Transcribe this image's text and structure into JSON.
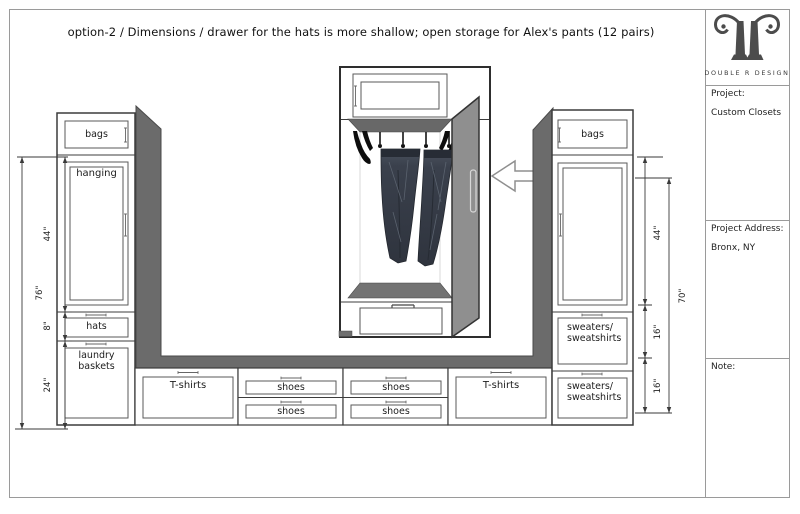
{
  "title": "option-2 / Dimensions / drawer for the hats is more shallow; open storage for Alex's pants (12 pairs)",
  "title_block": {
    "brand": "DOUBLE R DESIGN",
    "project_label": "Project:",
    "project_value": "Custom Closets",
    "address_label": "Project Address:",
    "address_value": "Bronx, NY",
    "note_label": "Note:"
  },
  "left_tower": {
    "cabinet": "bags",
    "door": "hanging",
    "drawer_small": "hats",
    "drawer_large": "laundry baskets",
    "dims": {
      "total": "76\"",
      "hanging": "44\"",
      "hats": "8\"",
      "laundry": "24\""
    }
  },
  "right_tower": {
    "cabinet": "bags",
    "drawer_1": "sweaters/ sweatshirts",
    "drawer_2": "sweaters/ sweatshirts",
    "dims": {
      "hanging": "44\"",
      "drawer_1": "16\"",
      "drawer_2": "16\"",
      "total": "70\""
    }
  },
  "base_row": {
    "tshirts_left": "T-shirts",
    "shoes": [
      "shoes",
      "shoes",
      "shoes",
      "shoes"
    ],
    "tshirts_right": "T-shirts"
  },
  "colors": {
    "panel_gray": "#6b6b6b",
    "door_gray": "#8f8f8f",
    "denim_dark": "#343a44",
    "line": "#3a3a3a"
  }
}
